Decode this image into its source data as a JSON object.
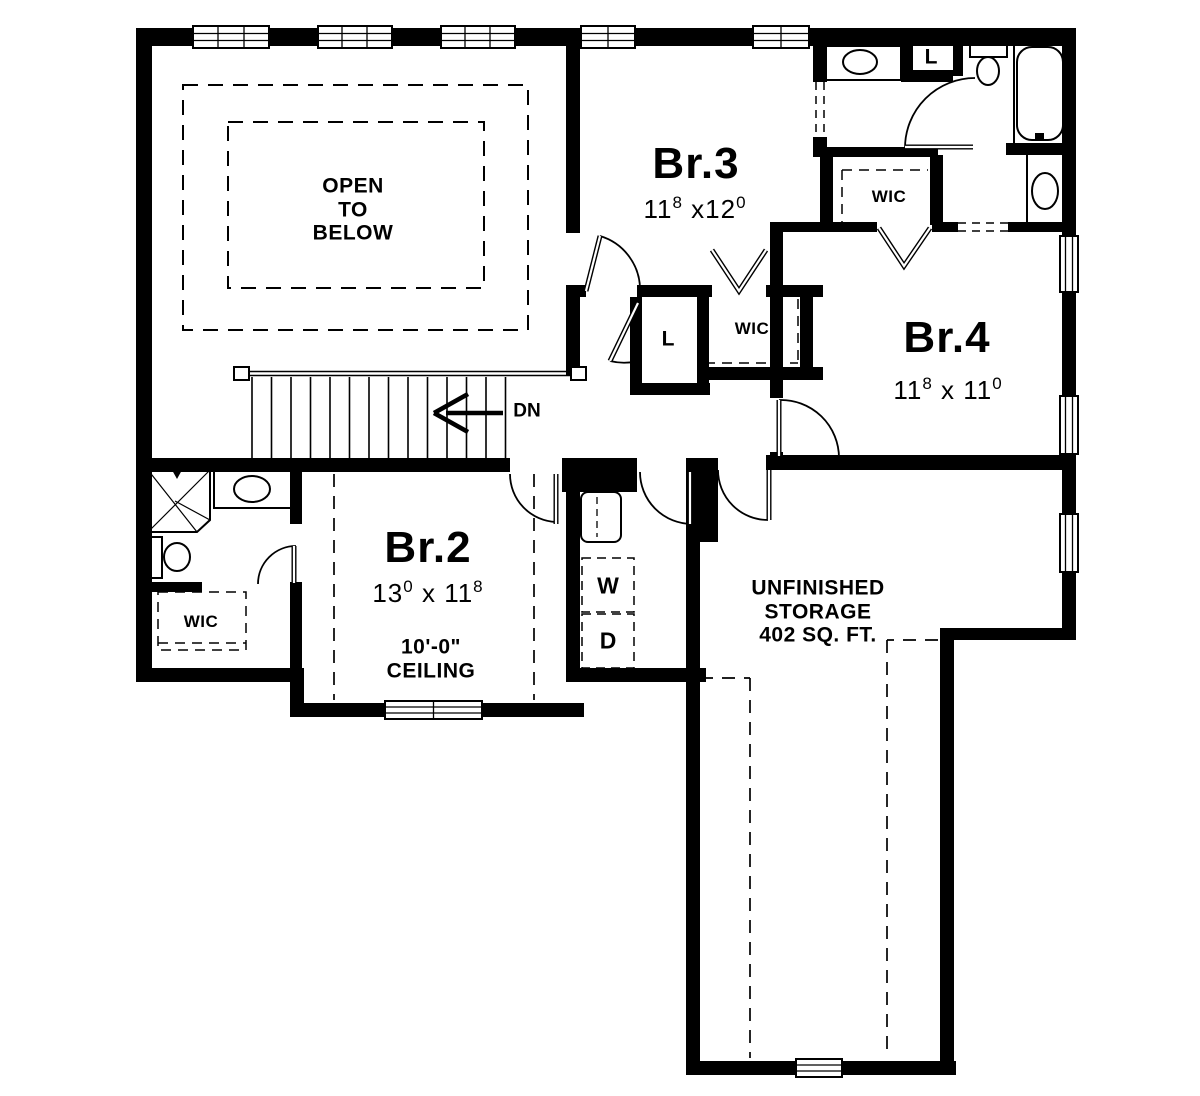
{
  "plan": {
    "title": "second-floor-plan",
    "colors": {
      "ink": "#000000",
      "paper": "#ffffff"
    },
    "rooms": {
      "open_below": {
        "line1": "OPEN",
        "line2": "TO",
        "line3": "BELOW"
      },
      "br2": {
        "name": "Br.2",
        "dim_a": "13",
        "dim_a_sup": "0",
        "dim_b": " x 11",
        "dim_b_sup": "8",
        "ceiling_line1": "10'-0\"",
        "ceiling_line2": "CEILING"
      },
      "br3": {
        "name": "Br.3",
        "dim_a": "11",
        "dim_a_sup": "8",
        "dim_b": " x12",
        "dim_b_sup": "0"
      },
      "br4": {
        "name": "Br.4",
        "dim_a": "11",
        "dim_a_sup": "8",
        "dim_b": " x 11",
        "dim_b_sup": "0"
      },
      "storage": {
        "line1": "UNFINISHED",
        "line2": "STORAGE",
        "line3": "402 SQ. FT."
      }
    },
    "labels": {
      "dn": "DN",
      "washer": "W",
      "dryer": "D",
      "wic_left": "WIC",
      "wic_br3": "WIC",
      "wic_br4": "WIC",
      "linen_hall": "L",
      "linen_bath": "L"
    }
  }
}
